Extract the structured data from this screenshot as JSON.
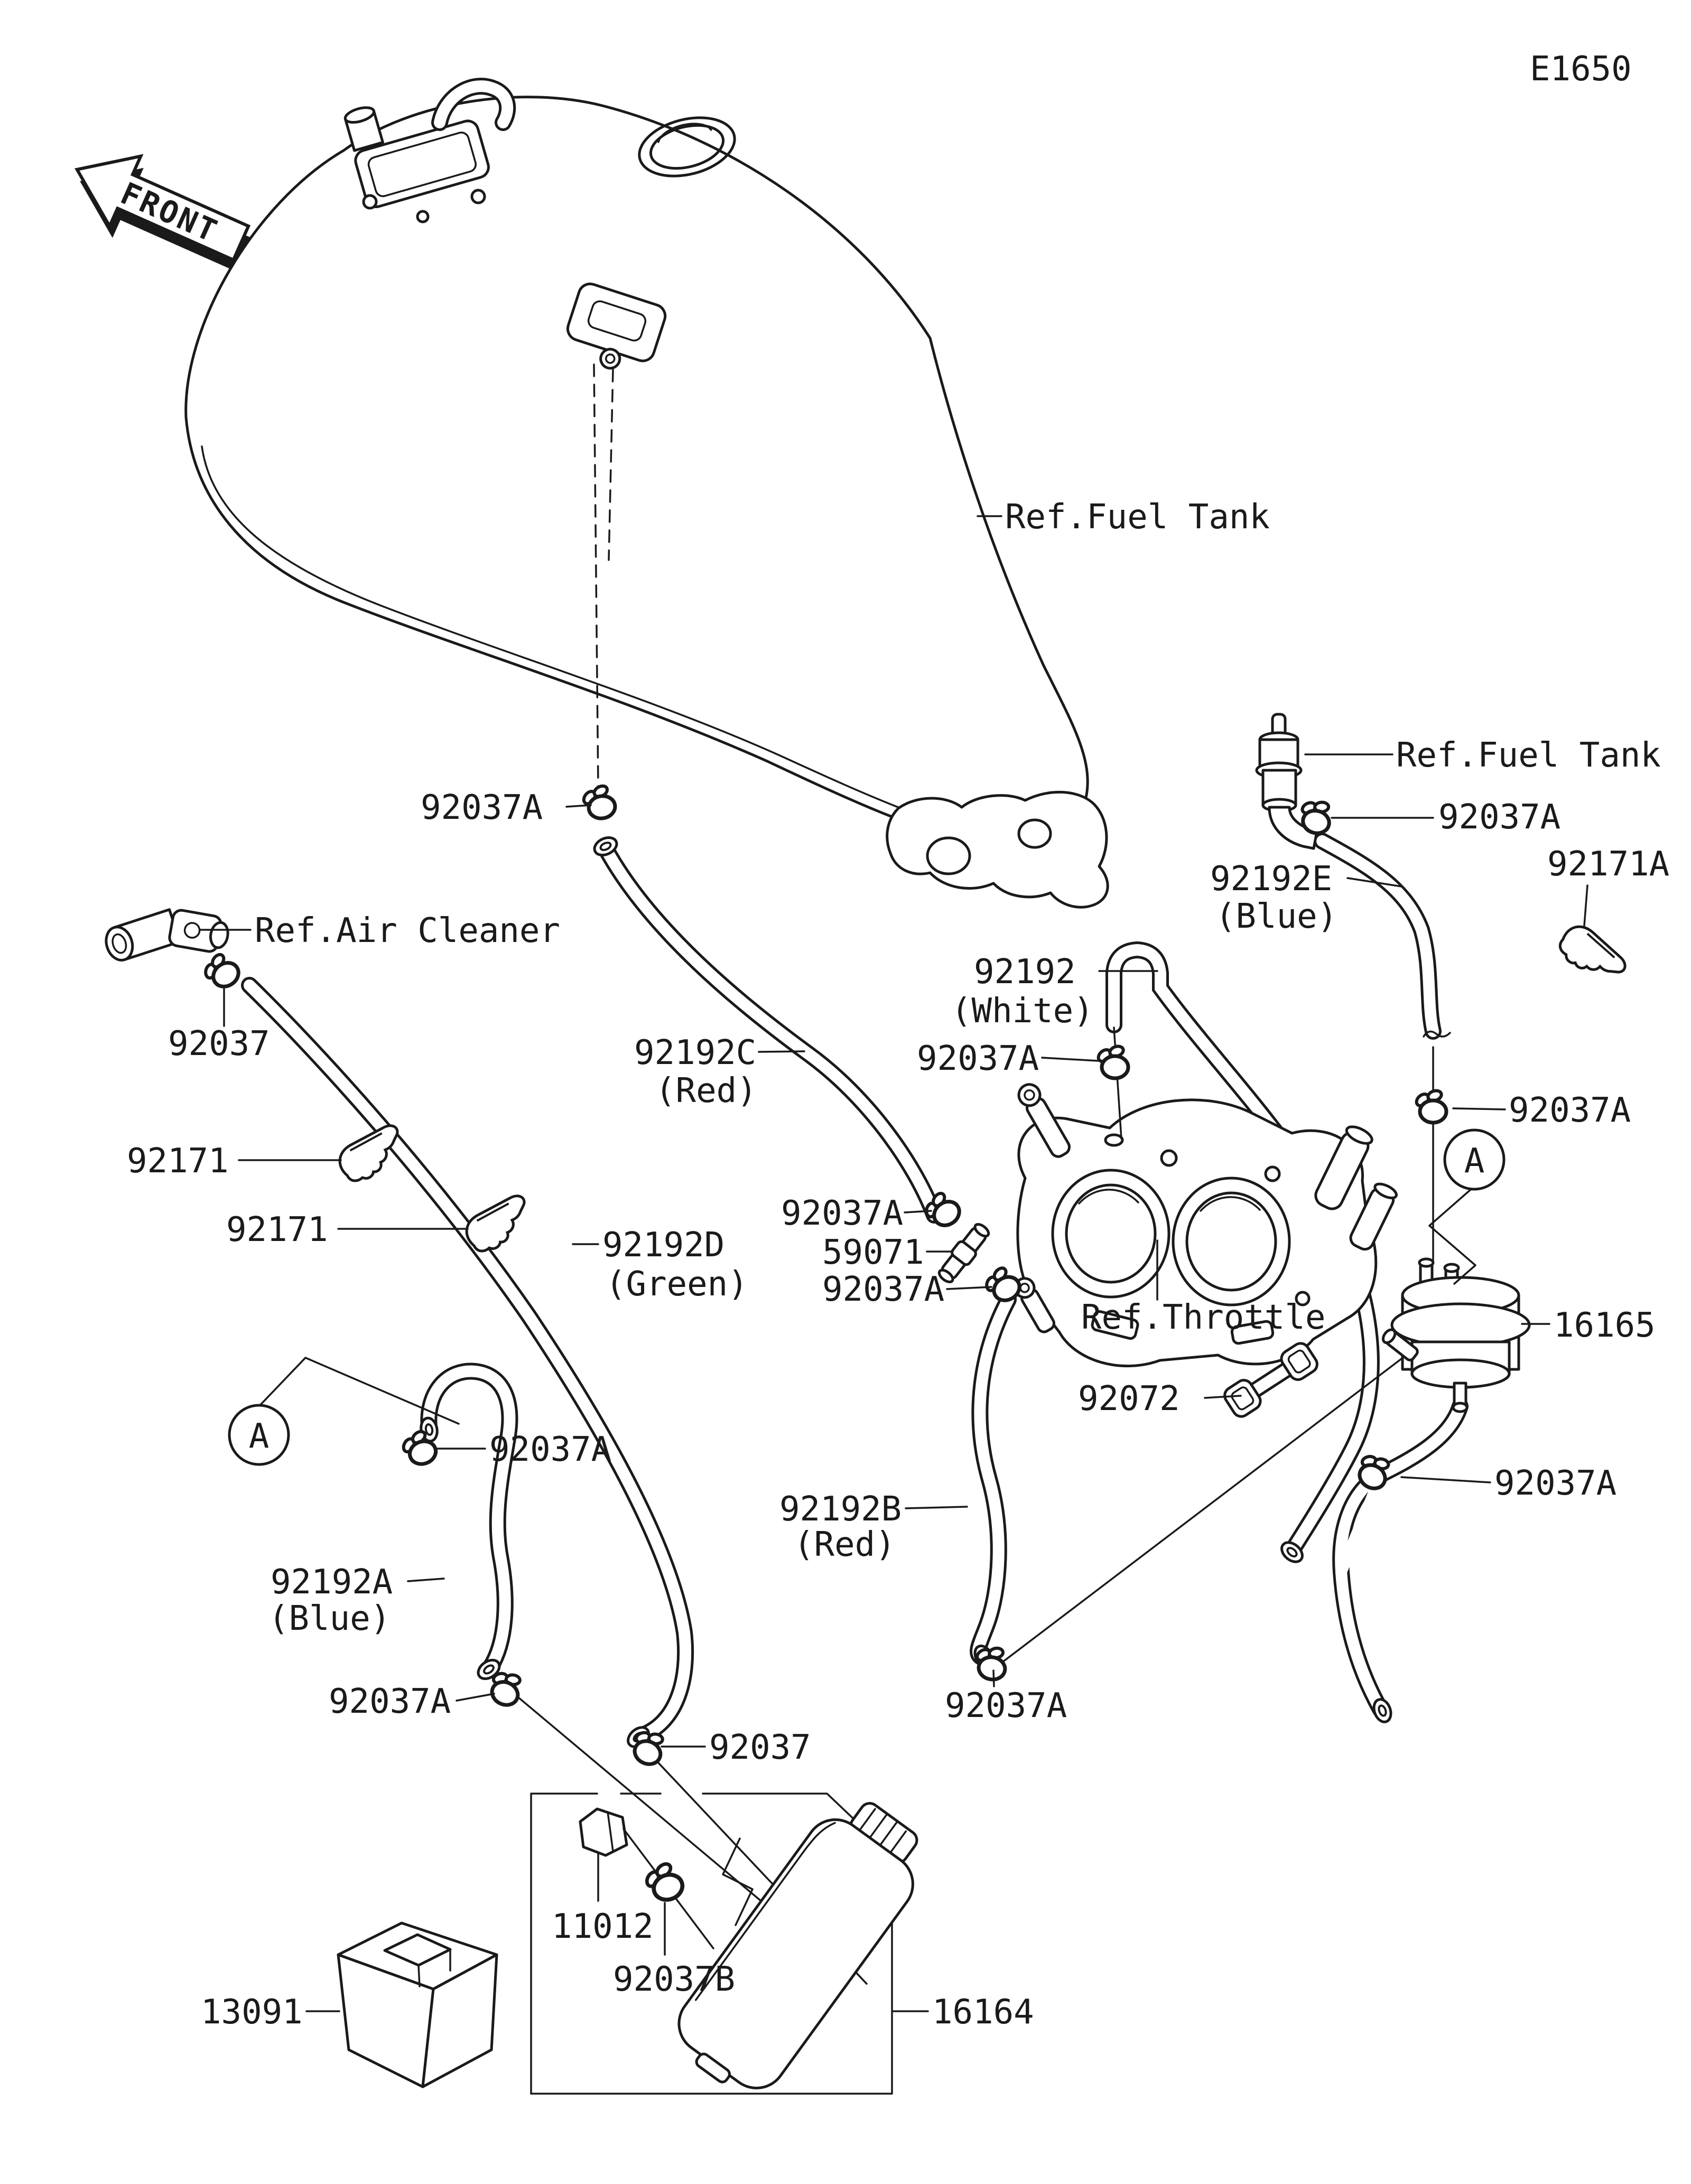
{
  "diagram": {
    "bg_color": "#ffffff",
    "line_color": "#1a1a1a",
    "kind": "motorcycle fuel evaporative system parts diagram"
  },
  "labels": [
    {
      "id": "page-code",
      "text": "E1650"
    },
    {
      "id": "front-marker",
      "text": "FRONT"
    },
    {
      "id": "ref-fuel-tank",
      "text": "Ref.Fuel Tank"
    },
    {
      "id": "ref-fuel-tank-valve",
      "text": "Ref.Fuel Tank"
    },
    {
      "id": "clamp-valve",
      "text": "92037A"
    },
    {
      "id": "hose-e",
      "text": "92192E"
    },
    {
      "id": "hose-e-color",
      "text": "(Blue)"
    },
    {
      "id": "clip-a",
      "text": "92171A"
    },
    {
      "id": "hose-white",
      "text": "92192"
    },
    {
      "id": "hose-white-color",
      "text": "(White)"
    },
    {
      "id": "clamp-white-hose",
      "text": "92037A"
    },
    {
      "id": "hose-c",
      "text": "92192C"
    },
    {
      "id": "hose-c-color",
      "text": "(Red)"
    },
    {
      "id": "ref-air-cleaner",
      "text": "Ref.Air Cleaner"
    },
    {
      "id": "clamp-air-cleaner",
      "text": "92037"
    },
    {
      "id": "clip-1",
      "text": "92171"
    },
    {
      "id": "clip-2",
      "text": "92171"
    },
    {
      "id": "hose-d",
      "text": "92192D"
    },
    {
      "id": "hose-d-color",
      "text": "(Green)"
    },
    {
      "id": "clamp-joint-upper",
      "text": "92037A"
    },
    {
      "id": "joint",
      "text": "59071"
    },
    {
      "id": "clamp-joint-lower",
      "text": "92037A"
    },
    {
      "id": "ref-throttle",
      "text": "Ref.Throttle"
    },
    {
      "id": "band",
      "text": "92072"
    },
    {
      "id": "fuel-filter",
      "text": "16165"
    },
    {
      "id": "clamp-filter-top",
      "text": "92037A"
    },
    {
      "id": "clamp-filter-bottom",
      "text": "92037A"
    },
    {
      "id": "hose-b",
      "text": "92192B"
    },
    {
      "id": "hose-b-color",
      "text": "(Red)"
    },
    {
      "id": "hose-a",
      "text": "92192A"
    },
    {
      "id": "hose-a-color",
      "text": "(Blue)"
    },
    {
      "id": "clamp-hook",
      "text": "92037A"
    },
    {
      "id": "clamp-hose-a-end",
      "text": "92037A"
    },
    {
      "id": "clamp-hose-d-end",
      "text": "92037"
    },
    {
      "id": "clamp-hose-b-end",
      "text": "92037A"
    },
    {
      "id": "cap",
      "text": "11012"
    },
    {
      "id": "clamp-canister",
      "text": "92037B"
    },
    {
      "id": "holder",
      "text": "13091"
    },
    {
      "id": "canister",
      "text": "16164"
    },
    {
      "id": "clamp-tank-bottom",
      "text": "92037A"
    },
    {
      "id": "detail-a-right",
      "text": "A"
    },
    {
      "id": "detail-a-left",
      "text": "A"
    }
  ]
}
